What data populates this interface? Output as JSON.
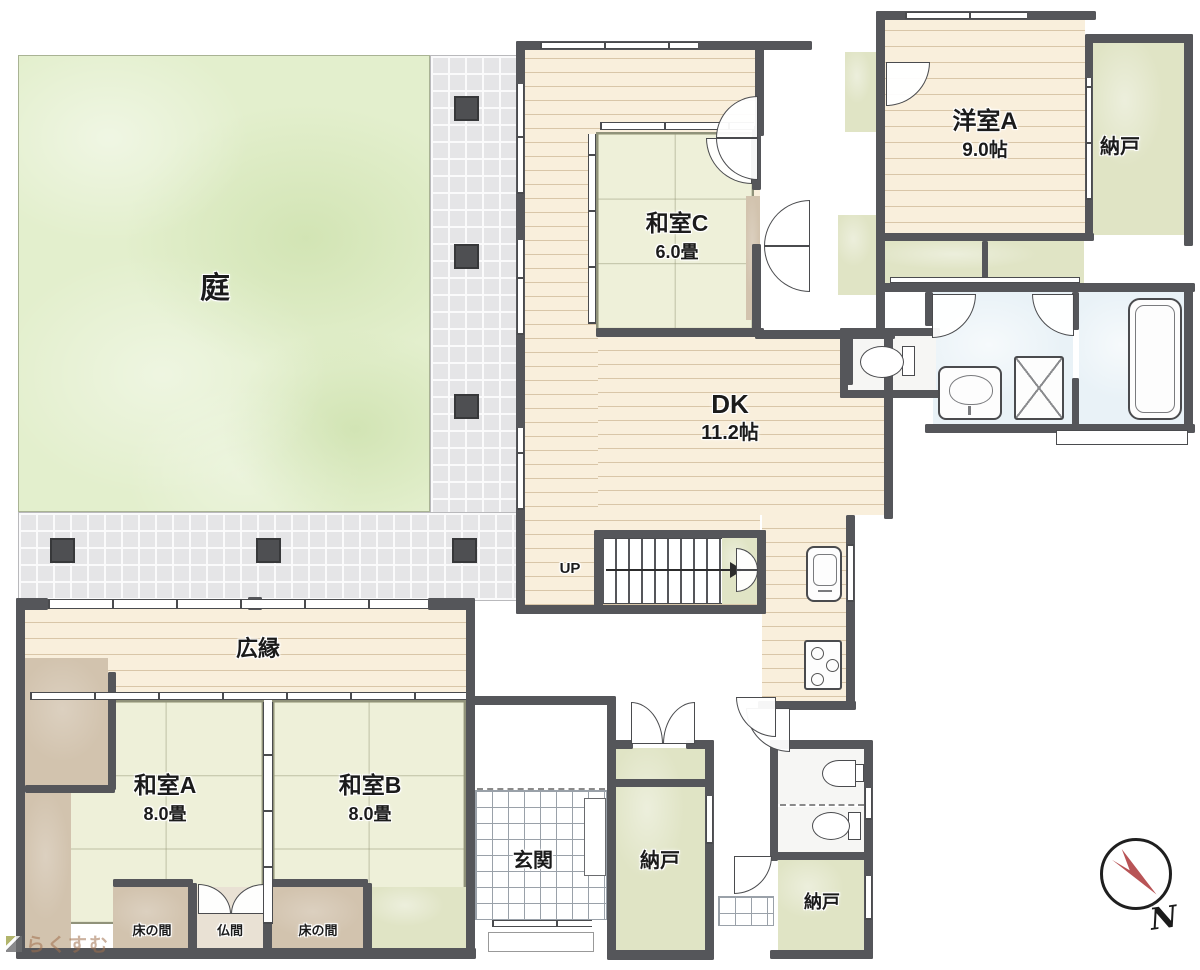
{
  "rooms": {
    "garden": {
      "label": "庭"
    },
    "veranda": {
      "label": "広縁"
    },
    "washitsuA": {
      "name": "和室A",
      "size": "8.0畳"
    },
    "washitsuB": {
      "name": "和室B",
      "size": "8.0畳"
    },
    "washitsuC": {
      "name": "和室C",
      "size": "6.0畳"
    },
    "yoshitsuA": {
      "name": "洋室A",
      "size": "9.0帖"
    },
    "dk": {
      "name": "DK",
      "size": "11.2帖"
    },
    "entrance": {
      "label": "玄関"
    },
    "storage": {
      "label": "納戸"
    },
    "alcove": {
      "label": "床の間"
    },
    "butsuma": {
      "label": "仏間"
    },
    "stairs": {
      "label": "UP"
    }
  },
  "compass": {
    "label": "N"
  },
  "watermark": {
    "label": "らくすむ"
  },
  "colors": {
    "wall": "#55565a",
    "tatami": "#eef0d9",
    "storage_green": "#e0e4c5",
    "garden_green": "#e3efcd",
    "wood": "#f9efdc",
    "walkway_tile": "#e5e5e7",
    "water_blue": "#e9f2f7",
    "alcove_brown": "#d2c3ae",
    "compass_red": "#b85456"
  }
}
